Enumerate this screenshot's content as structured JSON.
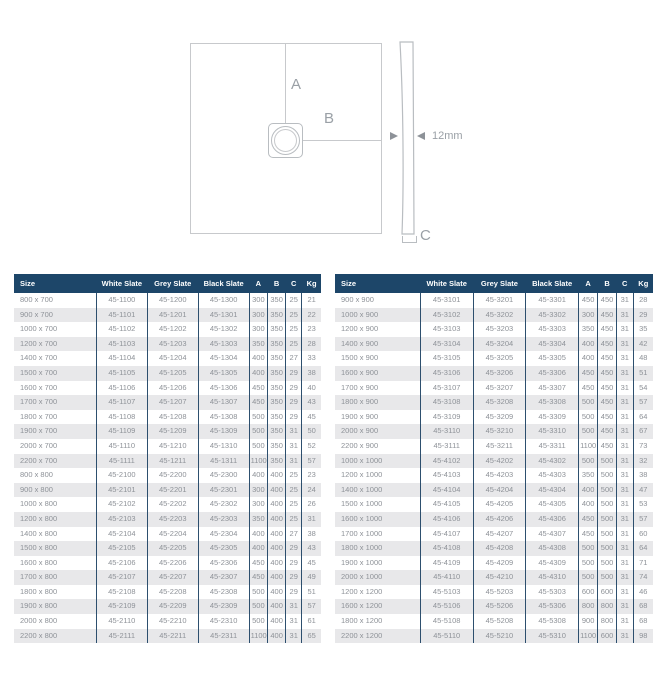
{
  "diagram": {
    "dim_a_label": "A",
    "dim_b_label": "B",
    "dim_c_label": "C",
    "thickness_label": "12mm"
  },
  "colors": {
    "header_bg": "#1d4669",
    "header_text": "#ffffff",
    "row_stripe": "#e8e8ea",
    "cell_text": "#8e9298",
    "column_border": "#2d4f6e",
    "diagram_line": "#c7c9cc",
    "diagram_text": "#9aa0a6"
  },
  "tables": [
    {
      "id": "left",
      "headers": [
        "Size",
        "White Slate",
        "Grey Slate",
        "Black Slate",
        "A",
        "B",
        "C",
        "Kg"
      ],
      "rows": [
        [
          "800 x 700",
          "45-1100",
          "45-1200",
          "45-1300",
          "300",
          "350",
          "25",
          "21"
        ],
        [
          "900 x 700",
          "45-1101",
          "45-1201",
          "45-1301",
          "300",
          "350",
          "25",
          "22"
        ],
        [
          "1000 x 700",
          "45-1102",
          "45-1202",
          "45-1302",
          "300",
          "350",
          "25",
          "23"
        ],
        [
          "1200 x 700",
          "45-1103",
          "45-1203",
          "45-1303",
          "350",
          "350",
          "25",
          "28"
        ],
        [
          "1400 x 700",
          "45-1104",
          "45-1204",
          "45-1304",
          "400",
          "350",
          "27",
          "33"
        ],
        [
          "1500 x 700",
          "45-1105",
          "45-1205",
          "45-1305",
          "400",
          "350",
          "29",
          "38"
        ],
        [
          "1600 x 700",
          "45-1106",
          "45-1206",
          "45-1306",
          "450",
          "350",
          "29",
          "40"
        ],
        [
          "1700 x 700",
          "45-1107",
          "45-1207",
          "45-1307",
          "450",
          "350",
          "29",
          "43"
        ],
        [
          "1800 x 700",
          "45-1108",
          "45-1208",
          "45-1308",
          "500",
          "350",
          "29",
          "45"
        ],
        [
          "1900 x 700",
          "45-1109",
          "45-1209",
          "45-1309",
          "500",
          "350",
          "31",
          "50"
        ],
        [
          "2000 x 700",
          "45-1110",
          "45-1210",
          "45-1310",
          "500",
          "350",
          "31",
          "52"
        ],
        [
          "2200 x 700",
          "45-1111",
          "45-1211",
          "45-1311",
          "1100",
          "350",
          "31",
          "57"
        ],
        [
          "800 x 800",
          "45-2100",
          "45-2200",
          "45-2300",
          "400",
          "400",
          "25",
          "23"
        ],
        [
          "900 x 800",
          "45-2101",
          "45-2201",
          "45-2301",
          "300",
          "400",
          "25",
          "24"
        ],
        [
          "1000 x 800",
          "45-2102",
          "45-2202",
          "45-2302",
          "300",
          "400",
          "25",
          "26"
        ],
        [
          "1200 x 800",
          "45-2103",
          "45-2203",
          "45-2303",
          "350",
          "400",
          "25",
          "31"
        ],
        [
          "1400 x 800",
          "45-2104",
          "45-2204",
          "45-2304",
          "400",
          "400",
          "27",
          "38"
        ],
        [
          "1500 x 800",
          "45-2105",
          "45-2205",
          "45-2305",
          "400",
          "400",
          "29",
          "43"
        ],
        [
          "1600 x 800",
          "45-2106",
          "45-2206",
          "45-2306",
          "450",
          "400",
          "29",
          "45"
        ],
        [
          "1700 x 800",
          "45-2107",
          "45-2207",
          "45-2307",
          "450",
          "400",
          "29",
          "49"
        ],
        [
          "1800 x 800",
          "45-2108",
          "45-2208",
          "45-2308",
          "500",
          "400",
          "29",
          "51"
        ],
        [
          "1900 x 800",
          "45-2109",
          "45-2209",
          "45-2309",
          "500",
          "400",
          "31",
          "57"
        ],
        [
          "2000 x 800",
          "45-2110",
          "45-2210",
          "45-2310",
          "500",
          "400",
          "31",
          "61"
        ],
        [
          "2200 x 800",
          "45-2111",
          "45-2211",
          "45-2311",
          "1100",
          "400",
          "31",
          "65"
        ]
      ]
    },
    {
      "id": "right",
      "headers": [
        "Size",
        "White Slate",
        "Grey Slate",
        "Black Slate",
        "A",
        "B",
        "C",
        "Kg"
      ],
      "rows": [
        [
          "900 x 900",
          "45-3101",
          "45-3201",
          "45-3301",
          "450",
          "450",
          "31",
          "28"
        ],
        [
          "1000 x 900",
          "45-3102",
          "45-3202",
          "45-3302",
          "300",
          "450",
          "31",
          "29"
        ],
        [
          "1200 x 900",
          "45-3103",
          "45-3203",
          "45-3303",
          "350",
          "450",
          "31",
          "35"
        ],
        [
          "1400 x 900",
          "45-3104",
          "45-3204",
          "45-3304",
          "400",
          "450",
          "31",
          "42"
        ],
        [
          "1500 x 900",
          "45-3105",
          "45-3205",
          "45-3305",
          "400",
          "450",
          "31",
          "48"
        ],
        [
          "1600 x 900",
          "45-3106",
          "45-3206",
          "45-3306",
          "450",
          "450",
          "31",
          "51"
        ],
        [
          "1700 x 900",
          "45-3107",
          "45-3207",
          "45-3307",
          "450",
          "450",
          "31",
          "54"
        ],
        [
          "1800 x 900",
          "45-3108",
          "45-3208",
          "45-3308",
          "500",
          "450",
          "31",
          "57"
        ],
        [
          "1900 x 900",
          "45-3109",
          "45-3209",
          "45-3309",
          "500",
          "450",
          "31",
          "64"
        ],
        [
          "2000 x 900",
          "45-3110",
          "45-3210",
          "45-3310",
          "500",
          "450",
          "31",
          "67"
        ],
        [
          "2200 x 900",
          "45-3111",
          "45-3211",
          "45-3311",
          "1100",
          "450",
          "31",
          "73"
        ],
        [
          "1000 x 1000",
          "45-4102",
          "45-4202",
          "45-4302",
          "500",
          "500",
          "31",
          "32"
        ],
        [
          "1200 x 1000",
          "45-4103",
          "45-4203",
          "45-4303",
          "350",
          "500",
          "31",
          "38"
        ],
        [
          "1400 x 1000",
          "45-4104",
          "45-4204",
          "45-4304",
          "400",
          "500",
          "31",
          "47"
        ],
        [
          "1500 x 1000",
          "45-4105",
          "45-4205",
          "45-4305",
          "400",
          "500",
          "31",
          "53"
        ],
        [
          "1600 x 1000",
          "45-4106",
          "45-4206",
          "45-4306",
          "450",
          "500",
          "31",
          "57"
        ],
        [
          "1700 x 1000",
          "45-4107",
          "45-4207",
          "45-4307",
          "450",
          "500",
          "31",
          "60"
        ],
        [
          "1800 x 1000",
          "45-4108",
          "45-4208",
          "45-4308",
          "500",
          "500",
          "31",
          "64"
        ],
        [
          "1900 x 1000",
          "45-4109",
          "45-4209",
          "45-4309",
          "500",
          "500",
          "31",
          "71"
        ],
        [
          "2000 x 1000",
          "45-4110",
          "45-4210",
          "45-4310",
          "500",
          "500",
          "31",
          "74"
        ],
        [
          "1200 x 1200",
          "45-5103",
          "45-5203",
          "45-5303",
          "600",
          "600",
          "31",
          "46"
        ],
        [
          "1600 x 1200",
          "45-5106",
          "45-5206",
          "45-5306",
          "800",
          "800",
          "31",
          "68"
        ],
        [
          "1800 x 1200",
          "45-5108",
          "45-5208",
          "45-5308",
          "900",
          "800",
          "31",
          "68"
        ],
        [
          "2200 x 1200",
          "45-5110",
          "45-5210",
          "45-5310",
          "1100",
          "600",
          "31",
          "98"
        ]
      ]
    }
  ]
}
